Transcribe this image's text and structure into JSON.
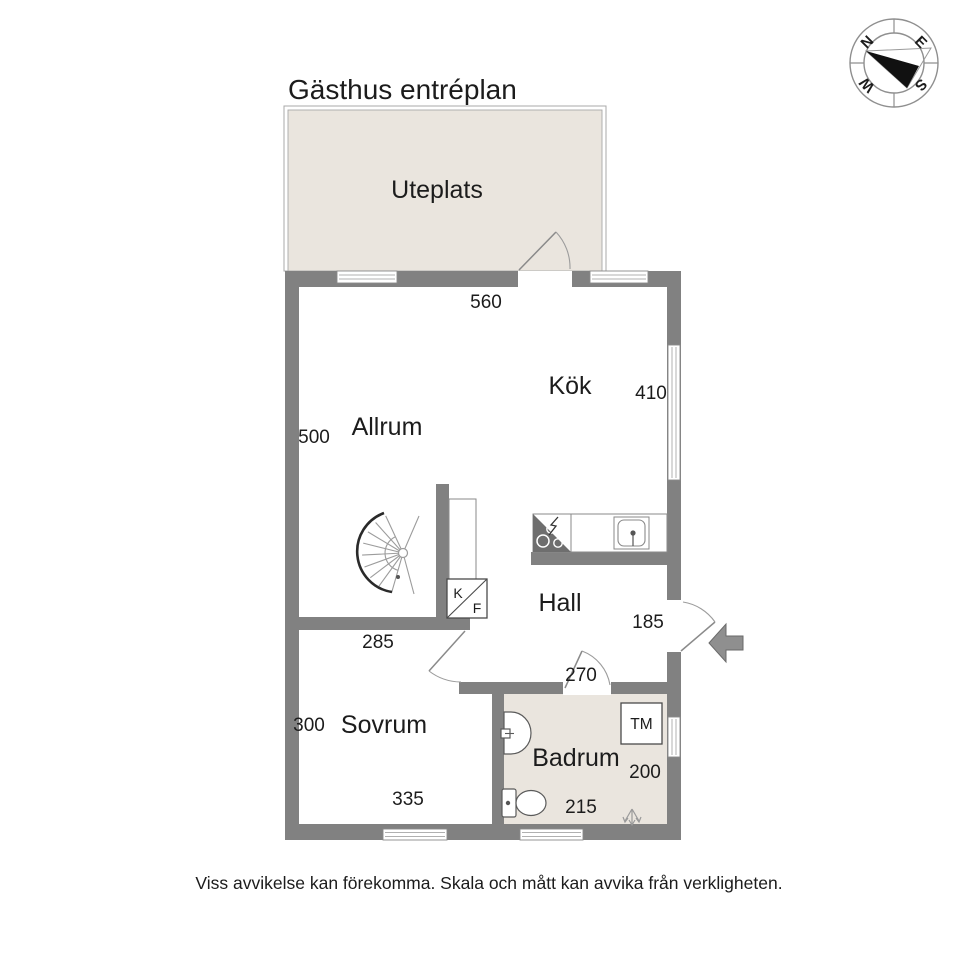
{
  "title": "Gästhus entréplan",
  "disclaimer": "Viss avvikelse kan förekomma. Skala och mått kan avvika från verkligheten.",
  "compass": {
    "north": "N",
    "east": "E",
    "south": "S",
    "west": "W"
  },
  "rooms": {
    "uteplats": {
      "label": "Uteplats"
    },
    "allrum": {
      "label": "Allrum",
      "width_cm": "560",
      "height_cm": "500"
    },
    "kok": {
      "label": "Kök",
      "height_cm": "410"
    },
    "hall": {
      "label": "Hall",
      "width_cm": "185"
    },
    "sovrum": {
      "label": "Sovrum",
      "top_cm": "285",
      "height_cm": "300",
      "width_cm": "335"
    },
    "badrum": {
      "label": "Badrum",
      "door_cm": "270",
      "height_cm": "200",
      "width_cm": "215"
    }
  },
  "appliances": {
    "kyl": "K",
    "frys": "F",
    "tvattmaskin": "TM"
  },
  "colors": {
    "wall": "#818181",
    "floor": "#eae5de",
    "accent_line": "#9c9c9c",
    "text": "#1c1c1c",
    "stove_dark": "#6e6e6e",
    "arrow": "#8f8f8f"
  }
}
